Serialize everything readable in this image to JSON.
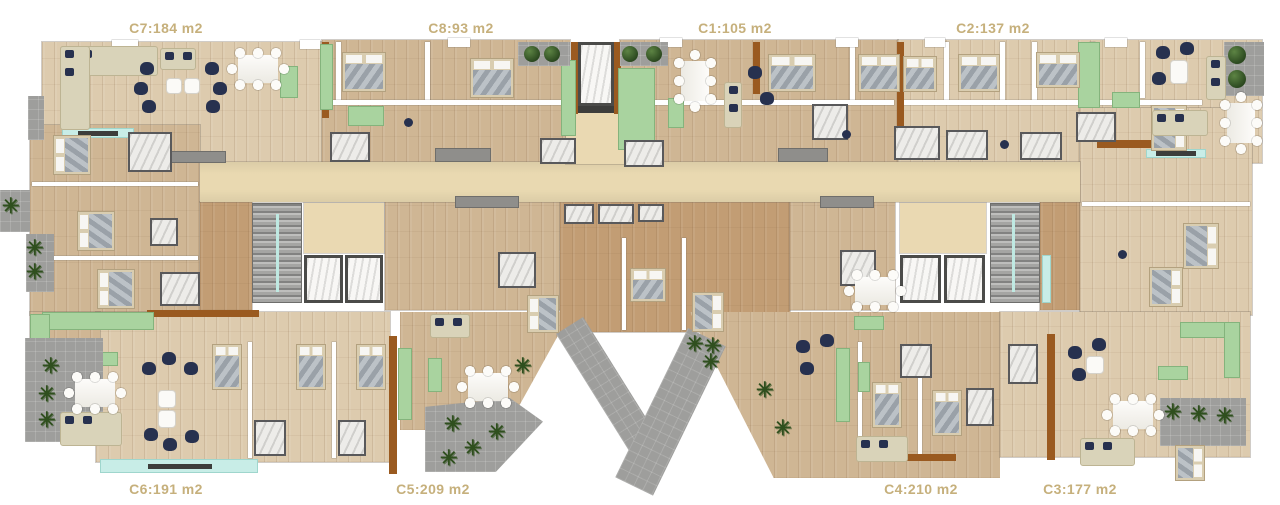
{
  "meta": {
    "type": "residential-floor-plan",
    "canvas": "1280x505"
  },
  "units": [
    {
      "id": "C7",
      "label": "C7:184 m2",
      "label_position": "top"
    },
    {
      "id": "C8",
      "label": "C8:93 m2",
      "label_position": "top"
    },
    {
      "id": "C1",
      "label": "C1:105 m2",
      "label_position": "top"
    },
    {
      "id": "C2",
      "label": "C2:137 m2",
      "label_position": "top"
    },
    {
      "id": "C6",
      "label": "C6:191 m2",
      "label_position": "bottom"
    },
    {
      "id": "C5",
      "label": "C5:209 m2",
      "label_position": "bottom"
    },
    {
      "id": "C4",
      "label": "C4:210 m2",
      "label_position": "bottom"
    },
    {
      "id": "C3",
      "label": "C3:177 m2",
      "label_position": "bottom"
    }
  ],
  "colors": {
    "label_text": "#c6b07c",
    "wood_floor": "#d6c1a1",
    "corridor_beige": "#e9d9b1",
    "kitchen_green": "#a9d39f",
    "glass_teal": "#c8ede7",
    "terrace_gray": "#9e9e9c",
    "furniture_navy": "#27314f",
    "door_brown": "#9a5a20",
    "wall_white": "#ffffff"
  },
  "icons": {
    "plant": "✳"
  }
}
